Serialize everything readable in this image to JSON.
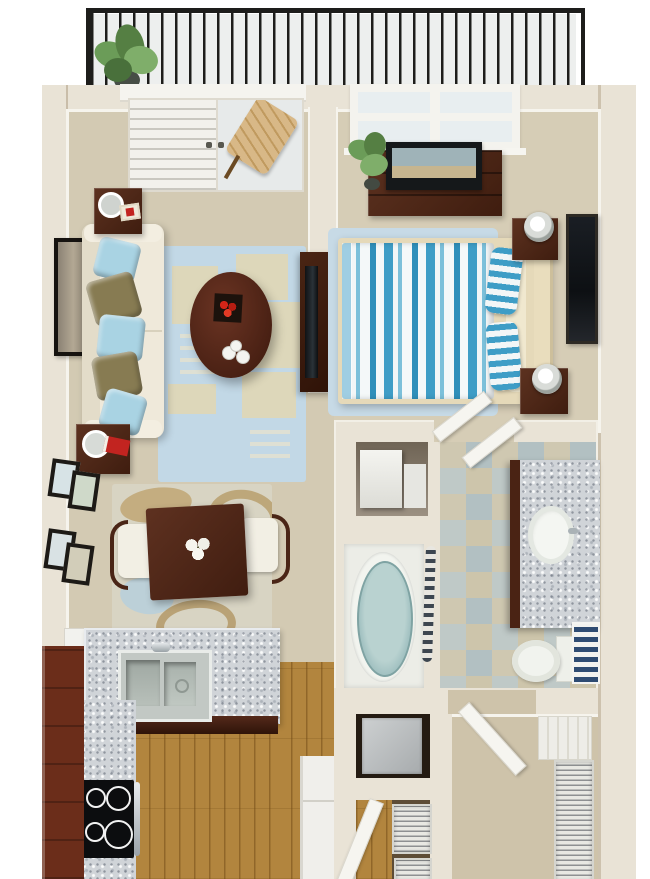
{
  "scene": {
    "type": "3d-floor-plan-rendering",
    "view": "top-down",
    "rooms": [
      {
        "name": "balcony",
        "items": [
          "metal-railing",
          "potted-plant",
          "wood-patio-chair"
        ]
      },
      {
        "name": "living-room",
        "items": [
          "french-door",
          "sofa",
          "throw-pillows",
          "end-table-with-lamp",
          "end-table-with-lamp",
          "wall-art",
          "blue-area-rug",
          "oval-coffee-table",
          "red-centerpiece",
          "cups",
          "tv-console",
          "flat-tv"
        ]
      },
      {
        "name": "dining-area",
        "items": [
          "square-dining-table",
          "flower-centerpiece",
          "dining-chair",
          "dining-chair",
          "abstract-rug",
          "picture-frames"
        ]
      },
      {
        "name": "kitchen",
        "items": [
          "l-shaped-granite-counter",
          "double-stainless-sink",
          "faucet",
          "black-cooktop",
          "red-brown-cabinets",
          "refrigerator",
          "hardwood-floor"
        ]
      },
      {
        "name": "bedroom",
        "items": [
          "window",
          "dresser",
          "flat-tv",
          "potted-plant",
          "bed-striped-comforter",
          "striped-pillows",
          "nightstand-with-lamp",
          "nightstand-with-lamp",
          "wall-art",
          "blue-rug"
        ]
      },
      {
        "name": "bathroom",
        "items": [
          "oval-bathtub",
          "shower-curtain",
          "tile-floor",
          "granite-vanity",
          "oval-sink",
          "toilet",
          "striped-towel-basket",
          "open-door"
        ]
      },
      {
        "name": "laundry-closet",
        "items": [
          "white-appliances"
        ]
      },
      {
        "name": "utility-closet",
        "items": [
          "water-heater",
          "wire-shelves",
          "entry-door"
        ]
      },
      {
        "name": "walk-in-closet",
        "items": [
          "wire-shelving",
          "white-shelf-tower",
          "open-door",
          "carpet"
        ]
      }
    ]
  },
  "colors": {
    "wall": "#e9e3d6",
    "trim": "#f6f4ed",
    "carpetLiving": "#d3cab3",
    "carpetBedroom": "#d6cdb6",
    "carpetCloset": "#cec3aa",
    "wood": "#b2853e",
    "balconyFloor": "#edefee",
    "railing": "#1d1d1b",
    "rugLivingBlue": "#c2d8e6",
    "rugTan": "#ddd7ba",
    "rugDining": "#d8d4c3",
    "sofa": "#efe9da",
    "pillowBlue": "#a9d3e3",
    "pillowOlive": "#877b52",
    "furnitureWood": "#512718",
    "accentRed": "#c22420",
    "granite": "#d0d4d8",
    "cabinetRed": "#6b2d1a",
    "steel": "#c2c8c4",
    "stove": "#0c0d0f",
    "bedFrame": "#e5d9b9",
    "bedBlue": "#3e9dc6",
    "bedWhite": "#f2f6f7",
    "tubBlue": "#a3c2c2",
    "tileBlue": "#b2c0c2",
    "tileTan": "#cdc5ab",
    "toilet": "#f1f3ee",
    "towelNavy": "#2e4b72",
    "appliance": "#c6c9ca",
    "plant": "#6b9c58",
    "tv": "#15181a",
    "screen": "#9fb3b8",
    "doorWhite": "#f6f5f0",
    "glass": "#e7eaea",
    "chairWood": "#d8b887",
    "wire": "#e8e8e3"
  }
}
